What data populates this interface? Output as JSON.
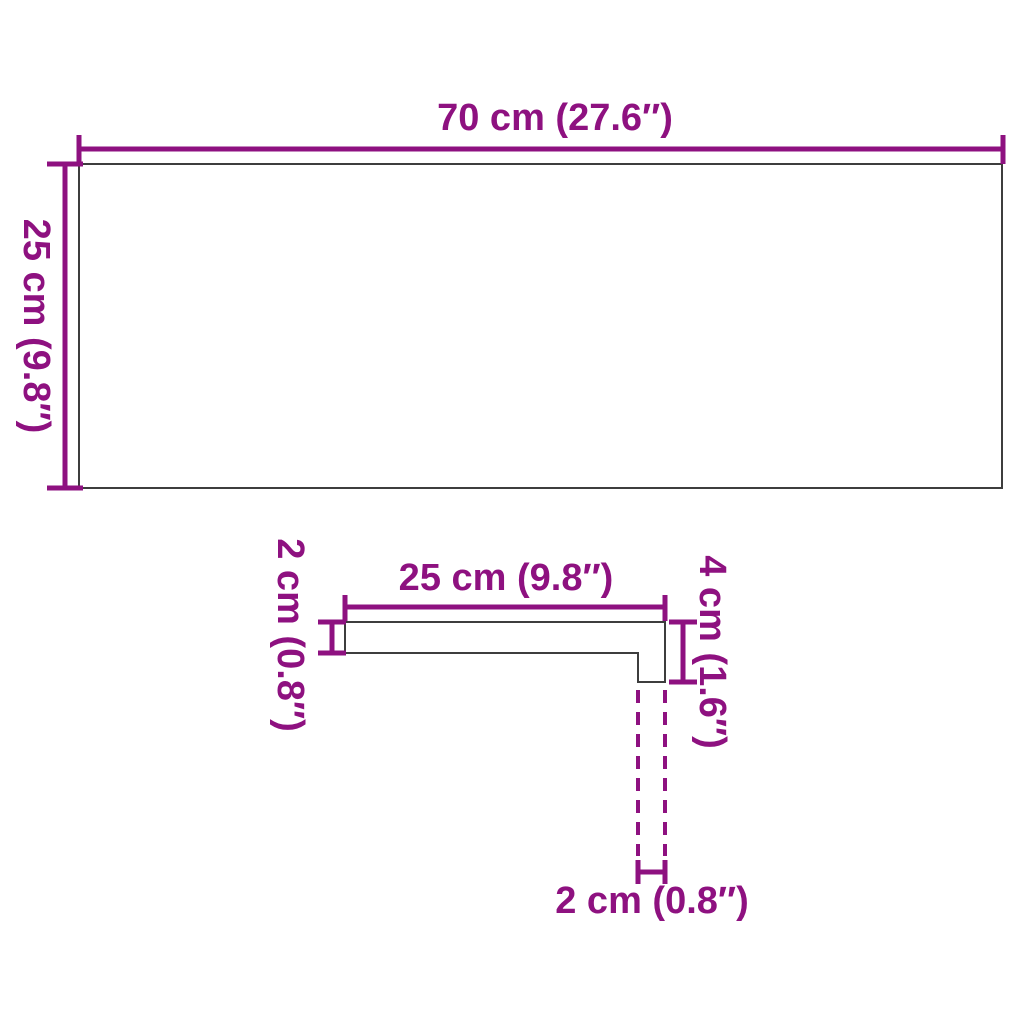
{
  "colors": {
    "dimension": "#8e1180",
    "outline": "#3d3d3d",
    "page": "#ffffff"
  },
  "top_view": {
    "width_label": "70 cm (27.6″)",
    "height_label": "25 cm (9.8″)"
  },
  "profile_view": {
    "depth_label": "25 cm (9.8″)",
    "thickness_label": "2 cm (0.8″)",
    "front_height_label": "4 cm (1.6″)",
    "nose_width_label": "2 cm (0.8″)"
  }
}
